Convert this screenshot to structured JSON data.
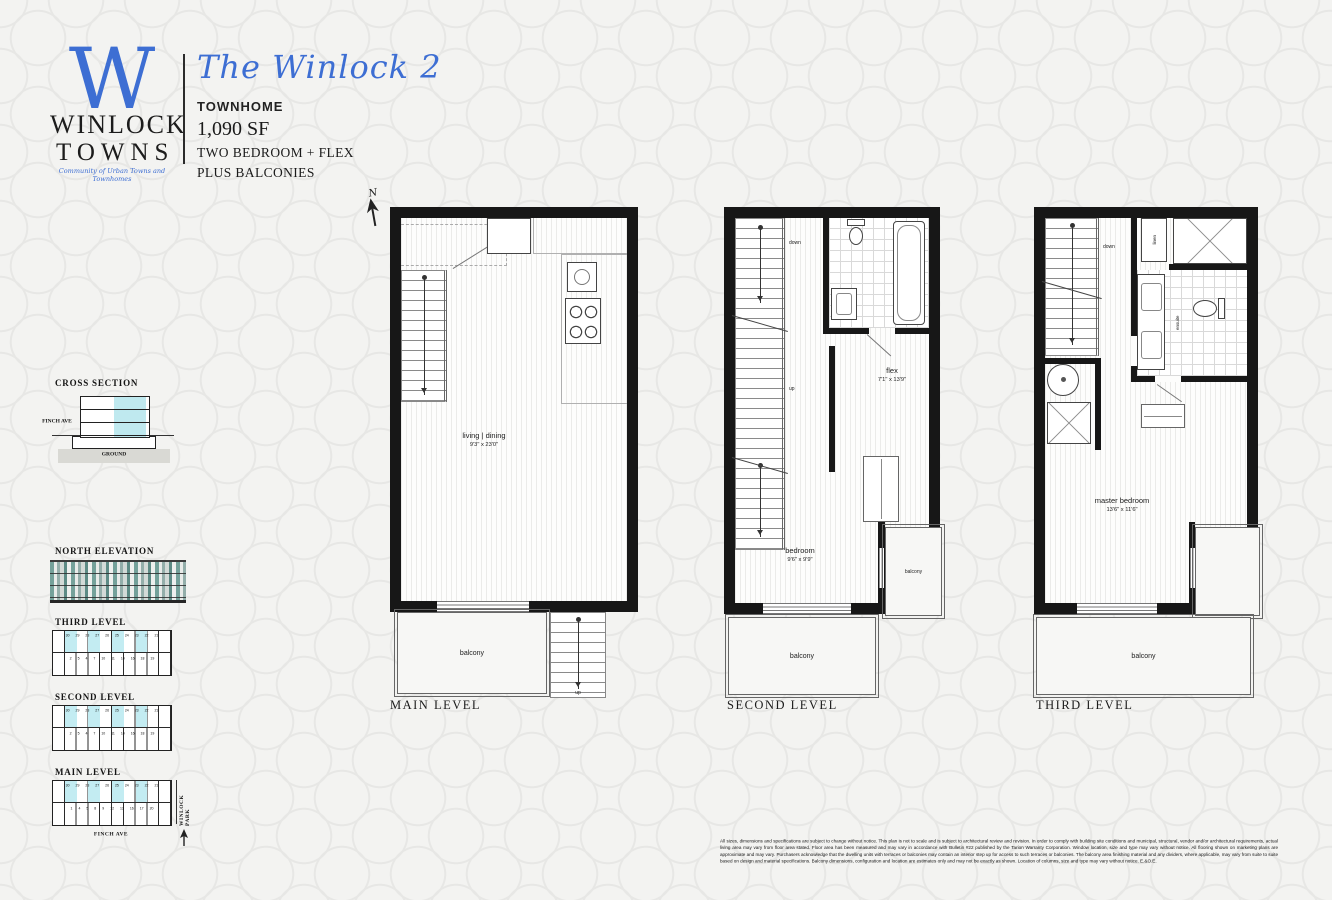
{
  "colors": {
    "accent_blue": "#3d6ed3",
    "highlight_cyan": "#c3ecf2",
    "wall_black": "#171717",
    "elevation_teal": "#74a19a"
  },
  "brand": {
    "monogram": "W",
    "name_top": "WINLOCK",
    "name_bottom": "TOWNS",
    "tagline": "Community of Urban Towns and Townhomes"
  },
  "header": {
    "plan_name": "The Winlock 2",
    "building_type": "TOWNHOME",
    "area": "1,090 SF",
    "feature_line_1": "TWO BEDROOM + FLEX",
    "feature_line_2": "PLUS BALCONIES"
  },
  "cross_section": {
    "title": "CROSS SECTION",
    "street_label": "FINCH AVE",
    "ground_label": "GROUND"
  },
  "north_elevation": {
    "title": "NORTH ELEVATION"
  },
  "keyplans": {
    "third": {
      "title": "THIRD LEVEL",
      "units_top": "30 29 28 27 26 25 24 23 22 21",
      "units_bottom": "2 5 4 7 10 11 14 16 18 19"
    },
    "second": {
      "title": "SECOND LEVEL",
      "units_top": "30 29 28 27 26 25 24 23 22 21",
      "units_bottom": "2 5 4 7 10 11 14 16 18 19"
    },
    "main": {
      "title": "MAIN LEVEL",
      "units_top": "30 29 28 27 26 25 24 23 22 21",
      "units_bottom": "1 4 5 8 9 12 13 16 17 20",
      "street_label": "FINCH AVE",
      "park_label": "WINLOCK PARK"
    }
  },
  "north_arrow": {
    "label": "N"
  },
  "plans": [
    {
      "caption": "MAIN LEVEL",
      "living_dining": {
        "name": "living | dining",
        "dims": "9'3\" x 23'0\""
      },
      "balcony_label": "balcony",
      "up_label": "up"
    },
    {
      "caption": "SECOND LEVEL",
      "down_label": "down",
      "up_label": "up",
      "flex": {
        "name": "flex",
        "dims": "7'1\" x 13'9\""
      },
      "bedroom": {
        "name": "bedroom",
        "dims": "9'6\" x 9'9\""
      },
      "balcony_side_label": "balcony",
      "balcony_bottom_label": "balcony"
    },
    {
      "caption": "THIRD LEVEL",
      "down_label": "down",
      "linen_label": "linen",
      "ensuite_label": "ensuite",
      "master_bedroom": {
        "name": "master bedroom",
        "dims": "13'6\" x 11'6\""
      },
      "balcony_label": "balcony"
    }
  ],
  "disclaimer": "All sizes, dimensions and specifications are subject to change without notice. This plan is not to scale and is subject to architectural review and revision. In order to comply with building site conditions and municipal, structural, vendor and/or architectural requirements, actual living area may vary from floor area stated. Floor area has been measured and may vary in accordance with Bulletin #22 published by the Tarion Warranty Corporation. Window location, size and type may vary without notice. All flooring shown on marketing plans are approximate and may vary. Purchasers acknowledge that the dwelling units with terraces or balconies may contain an interior step up for access to such terraces or balconies. The balcony area finishing material and any dividers, where applicable, may vary from suite to suite based on design and material specifications. Balcony dimensions, configuration and location are estimates only and may not be exactly as shown. Location of columns, size and type may vary without notice. E.&O.E."
}
